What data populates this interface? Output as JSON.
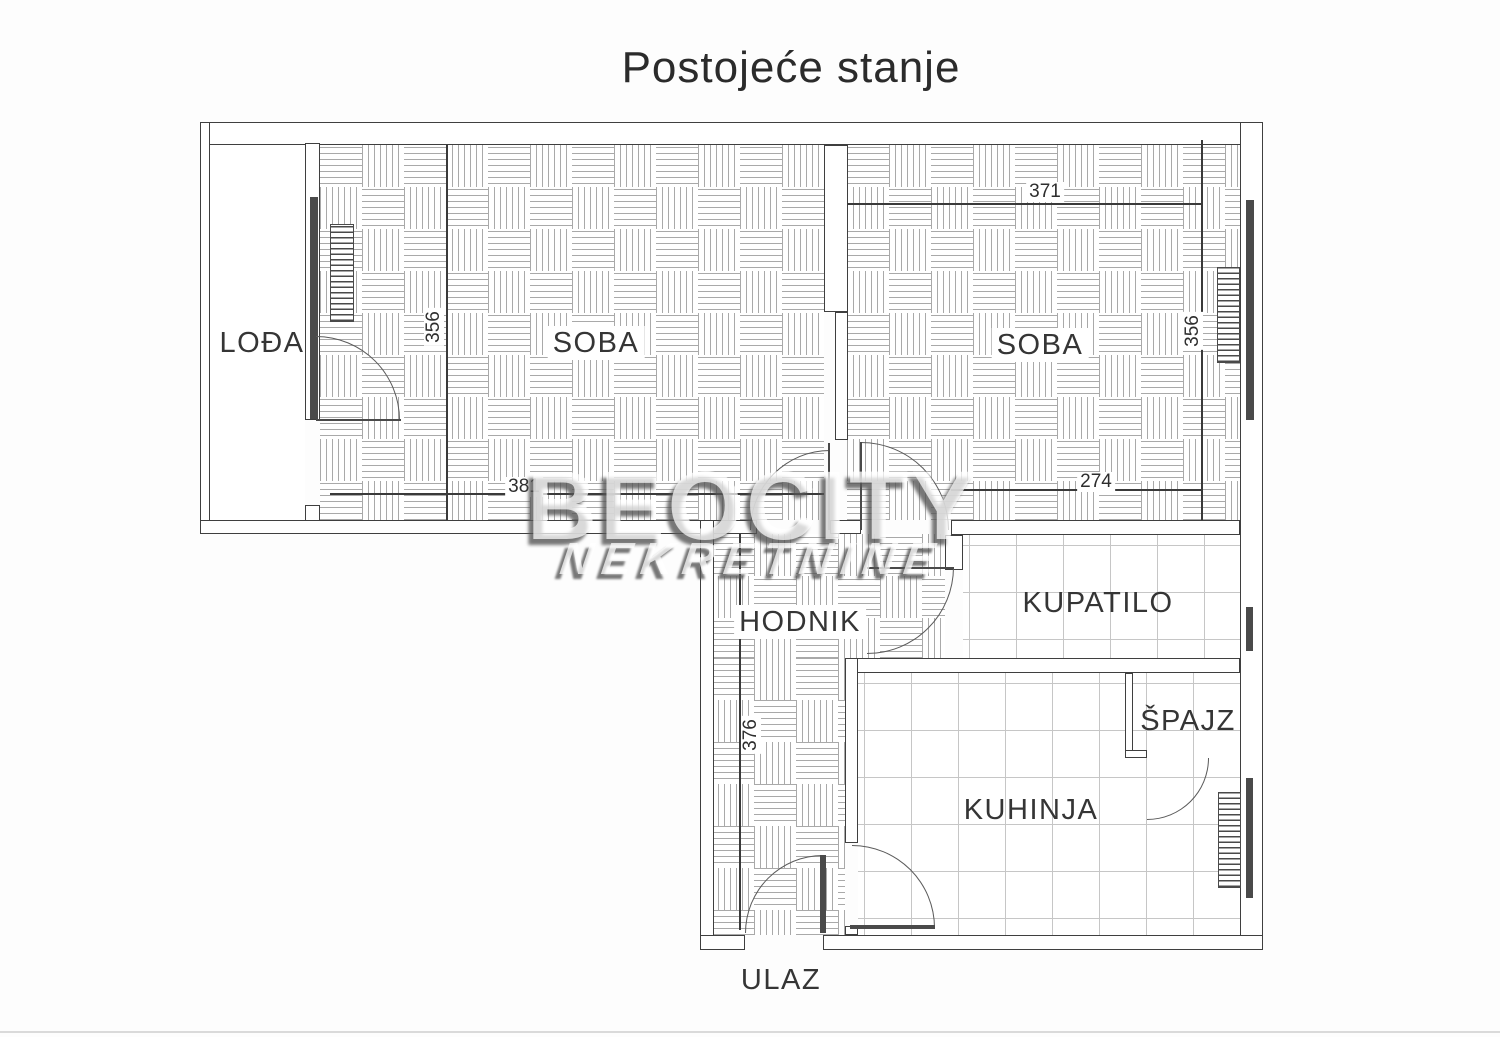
{
  "title": "Postojeće stanje",
  "watermark": {
    "line1": "BEOCITY",
    "line2": "NEKRETNINE"
  },
  "rooms": {
    "loda": {
      "label": "LOĐA"
    },
    "soba_left": {
      "label": "SOBA"
    },
    "soba_right": {
      "label": "SOBA"
    },
    "hodnik": {
      "label": "HODNIK"
    },
    "kupatilo": {
      "label": "KUPATILO"
    },
    "spajz": {
      "label": "ŠPAJZ"
    },
    "kuhinja": {
      "label": "KUHINJA"
    }
  },
  "entrance_label": "ULAZ",
  "dimensions_cm": {
    "soba_left_depth": "356",
    "soba_left_width": "381",
    "soba_right_width_top": "371",
    "soba_right_depth": "356",
    "soba_right_width_bottom": "274",
    "hodnik_length": "376"
  },
  "colors": {
    "wall_line": "#3f3f3f",
    "parquet_hatch_line": "#a9a9a9",
    "tile_grid_line": "#c6c6c6",
    "watermark_shadow": "#555555"
  }
}
